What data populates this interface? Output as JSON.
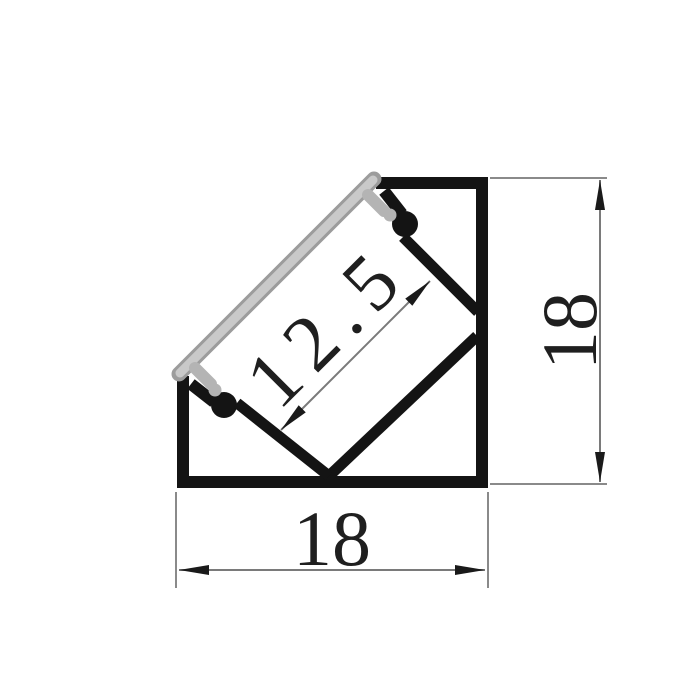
{
  "drawing": {
    "kind": "technical-cross-section",
    "dimensions": {
      "channel_width": {
        "label": "12.5"
      },
      "right_height": {
        "label": "18"
      },
      "bottom_width": {
        "label": "18"
      }
    },
    "colors": {
      "background": "#ffffff",
      "profile_outline": "#141414",
      "diffuser_fill": "#c9c9c9",
      "diffuser_edge": "#9c9c9c",
      "dimension_line": "#7a7a7a",
      "dimension_text": "#1f1f1f"
    }
  }
}
